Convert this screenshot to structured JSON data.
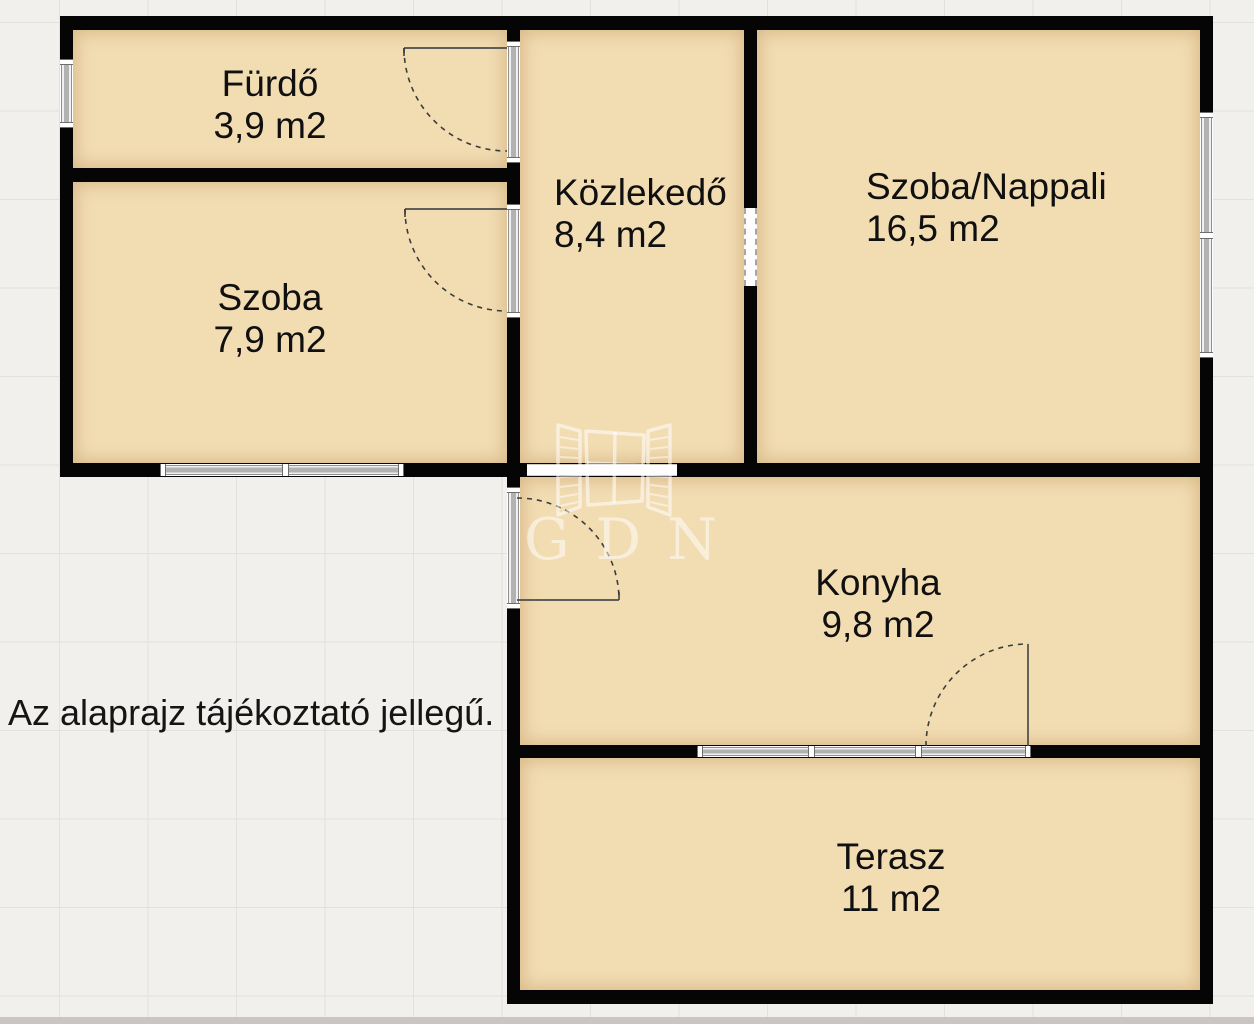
{
  "rooms": [
    {
      "id": "furdo",
      "name": "Fürdő",
      "area": "3,9 m2"
    },
    {
      "id": "szoba",
      "name": "Szoba",
      "area": "7,9 m2"
    },
    {
      "id": "kozlekedo",
      "name": "Közlekedő",
      "area": "8,4 m2"
    },
    {
      "id": "nappali",
      "name": "Szoba/Nappali",
      "area": "16,5 m2"
    },
    {
      "id": "konyha",
      "name": "Konyha",
      "area": "9,8 m2"
    },
    {
      "id": "terasz",
      "name": "Terasz",
      "area": "11 m2"
    }
  ],
  "disclaimer": "Az alaprajz tájékoztató jellegű.",
  "watermark": {
    "text": "GDN"
  },
  "colors": {
    "room_fill": "#f2dcb2",
    "wall": "#050505",
    "background": "#f1f0ec",
    "watermark": "rgba(255,255,255,0.52)"
  }
}
